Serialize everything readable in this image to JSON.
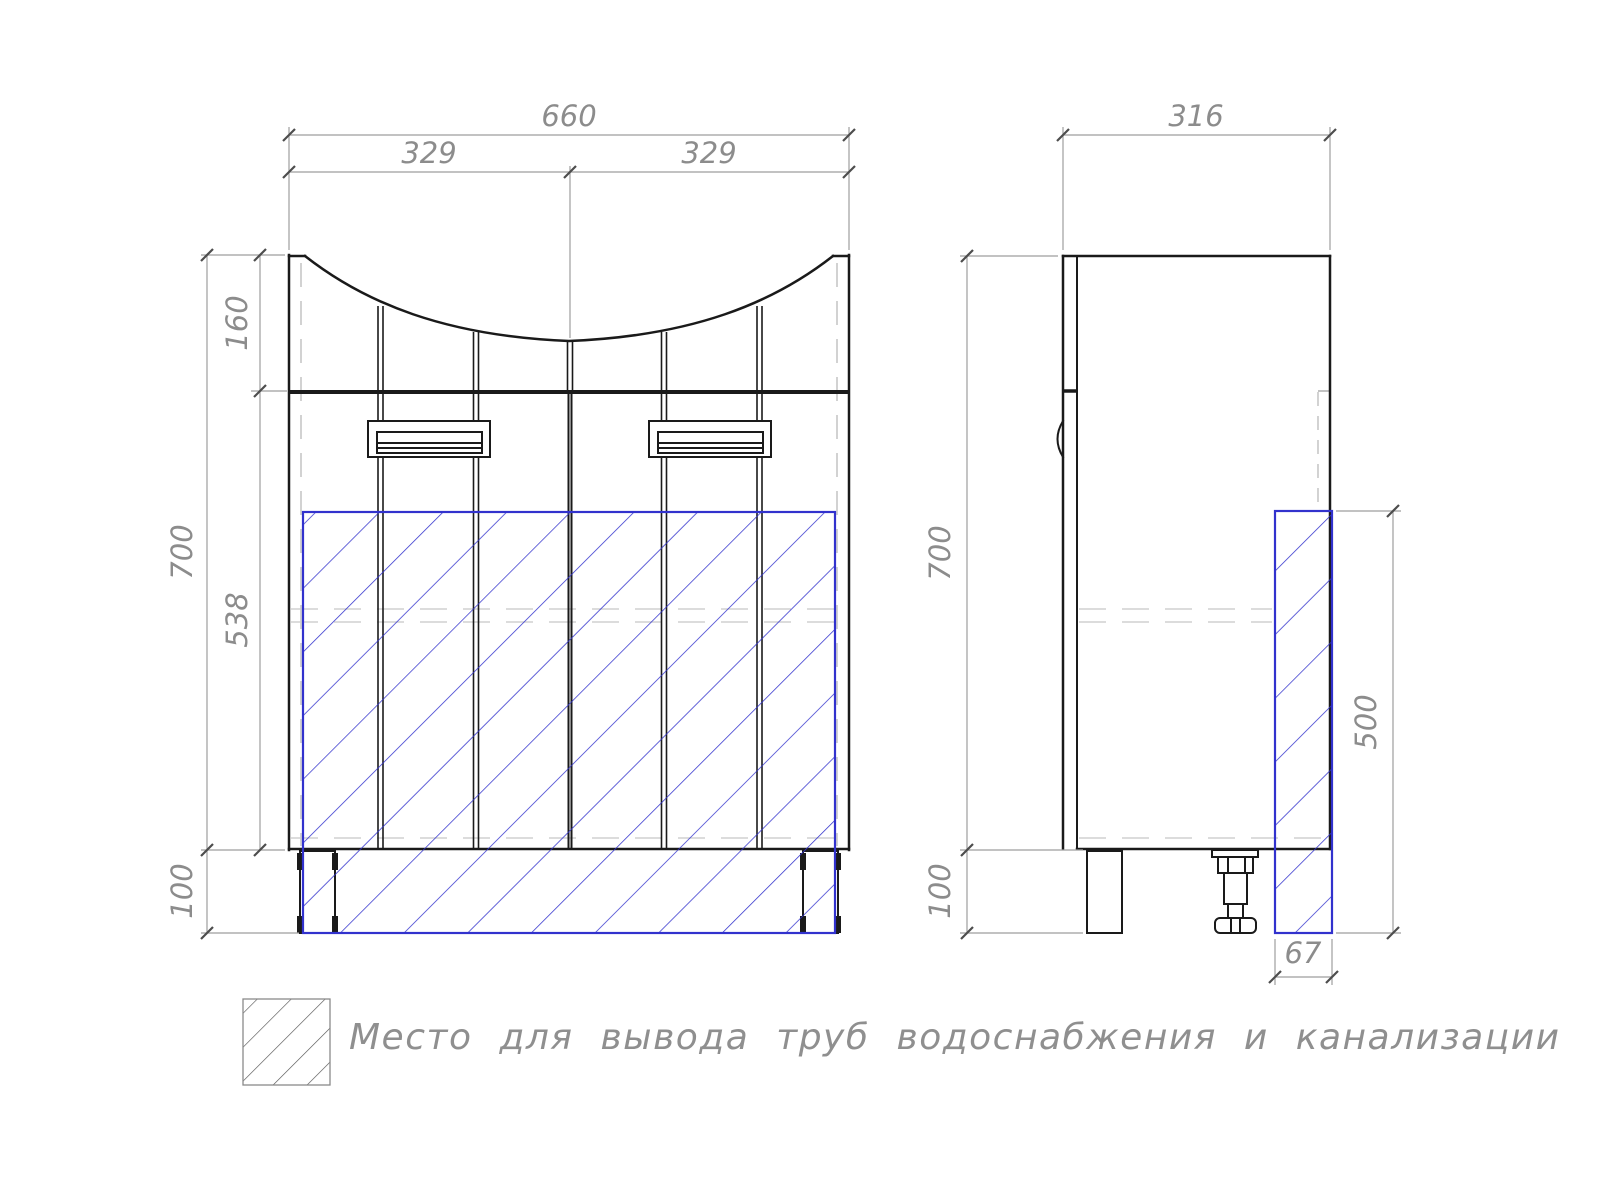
{
  "colors": {
    "background": "#ffffff",
    "outline": "#1a1a1a",
    "dimension": "#8c8c8c",
    "hidden": "#c8c8c8",
    "pipe_zone": "#3232cd",
    "legend_hatch": "#5a5a5a"
  },
  "front_view": {
    "dim_overall_width": "660",
    "dim_door_left": "329",
    "dim_door_right": "329",
    "dim_apron_height": "160",
    "dim_body_height": "700",
    "dim_door_zone_height": "538",
    "dim_leg_height": "100"
  },
  "side_view": {
    "dim_depth": "316",
    "dim_body_height": "700",
    "dim_leg_height": "100",
    "dim_pipe_zone_height": "500",
    "dim_pipe_zone_depth": "67"
  },
  "legend": {
    "pipe_zone_label": "Место для вывода труб водоснабжения и канализации"
  }
}
